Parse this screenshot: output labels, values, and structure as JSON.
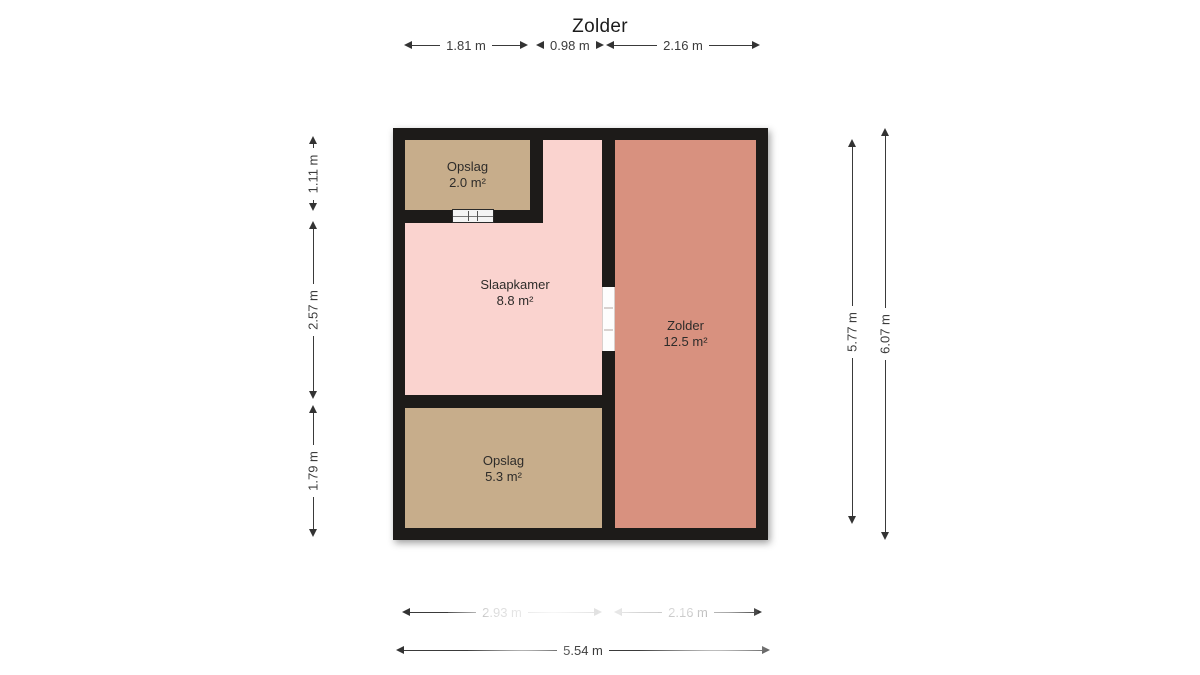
{
  "title": "Zolder",
  "rooms": [
    {
      "name": "Opslag",
      "area": "2.0 m²"
    },
    {
      "name": "Slaapkamer",
      "area": "8.8 m²"
    },
    {
      "name": "Zolder",
      "area": "12.5 m²"
    },
    {
      "name": "Opslag",
      "area": "5.3 m²"
    }
  ],
  "dimensions": {
    "top": [
      "1.81 m",
      "0.98 m",
      "2.16 m"
    ],
    "left": [
      "1.11 m",
      "2.57 m",
      "1.79 m"
    ],
    "right": [
      "5.77 m",
      "6.07 m"
    ],
    "bottom": [
      "2.93 m",
      "2.16 m"
    ],
    "bottom_total": "5.54 m"
  },
  "colors": {
    "wall": "#1d1b19",
    "opslag": "#c7ad8b",
    "slaapkamer": "#fad3cf",
    "zolder": "#d8917f",
    "dimtext": "#3c3c3c"
  },
  "icons": {
    "window": "window-symbol",
    "door": "door-opening-symbol"
  }
}
